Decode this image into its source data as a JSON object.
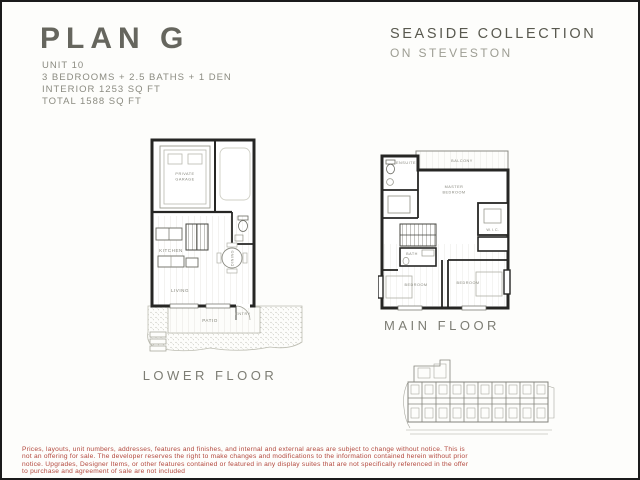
{
  "header": {
    "title": "PLAN G",
    "details": [
      "UNIT 10",
      "3 BEDROOMS + 2.5 BATHS + 1 DEN",
      "INTERIOR 1253 SQ FT",
      "TOTAL 1588 SQ FT"
    ],
    "brand": {
      "line1": "SEASIDE COLLECTION",
      "line2": "ON STEVESTON"
    }
  },
  "plans": {
    "lower": {
      "caption": "LOWER FLOOR",
      "rooms": {
        "garage_line1": "PRIVATE",
        "garage_line2": "GARAGE",
        "kitchen": "KITCHEN",
        "dining": "DINING",
        "living": "LIVING",
        "patio": "PATIO",
        "entry": "ENTRY"
      }
    },
    "main": {
      "caption": "MAIN FLOOR",
      "rooms": {
        "balcony": "BALCONY",
        "ensuite": "ENSUITE",
        "wic": "W.I.C.",
        "master_line1": "MASTER",
        "master_line2": "BEDROOM",
        "bath": "BATH",
        "bedroom_left": "BEDROOM",
        "bedroom_right": "BEDROOM"
      }
    }
  },
  "disclaimer": {
    "lines": [
      "Prices, layouts, unit numbers, addresses, features and finishes, and internal and external areas are subject to change without notice. This is",
      "not an offering for sale. The developer reserves the right to make changes and modifications to the information contained herein without prior",
      "notice. Upgrades, Designer Items, or other features contained or featured in any display suites that are not specifically referenced in the offer",
      "to purchase and agreement of sale are not included"
    ]
  },
  "colors": {
    "wall": "#262624",
    "thin_line": "#8c8c84",
    "faint_line": "#c4c4bc",
    "disclaimer_red": "#b2473c",
    "title_gray": "#66665e"
  }
}
